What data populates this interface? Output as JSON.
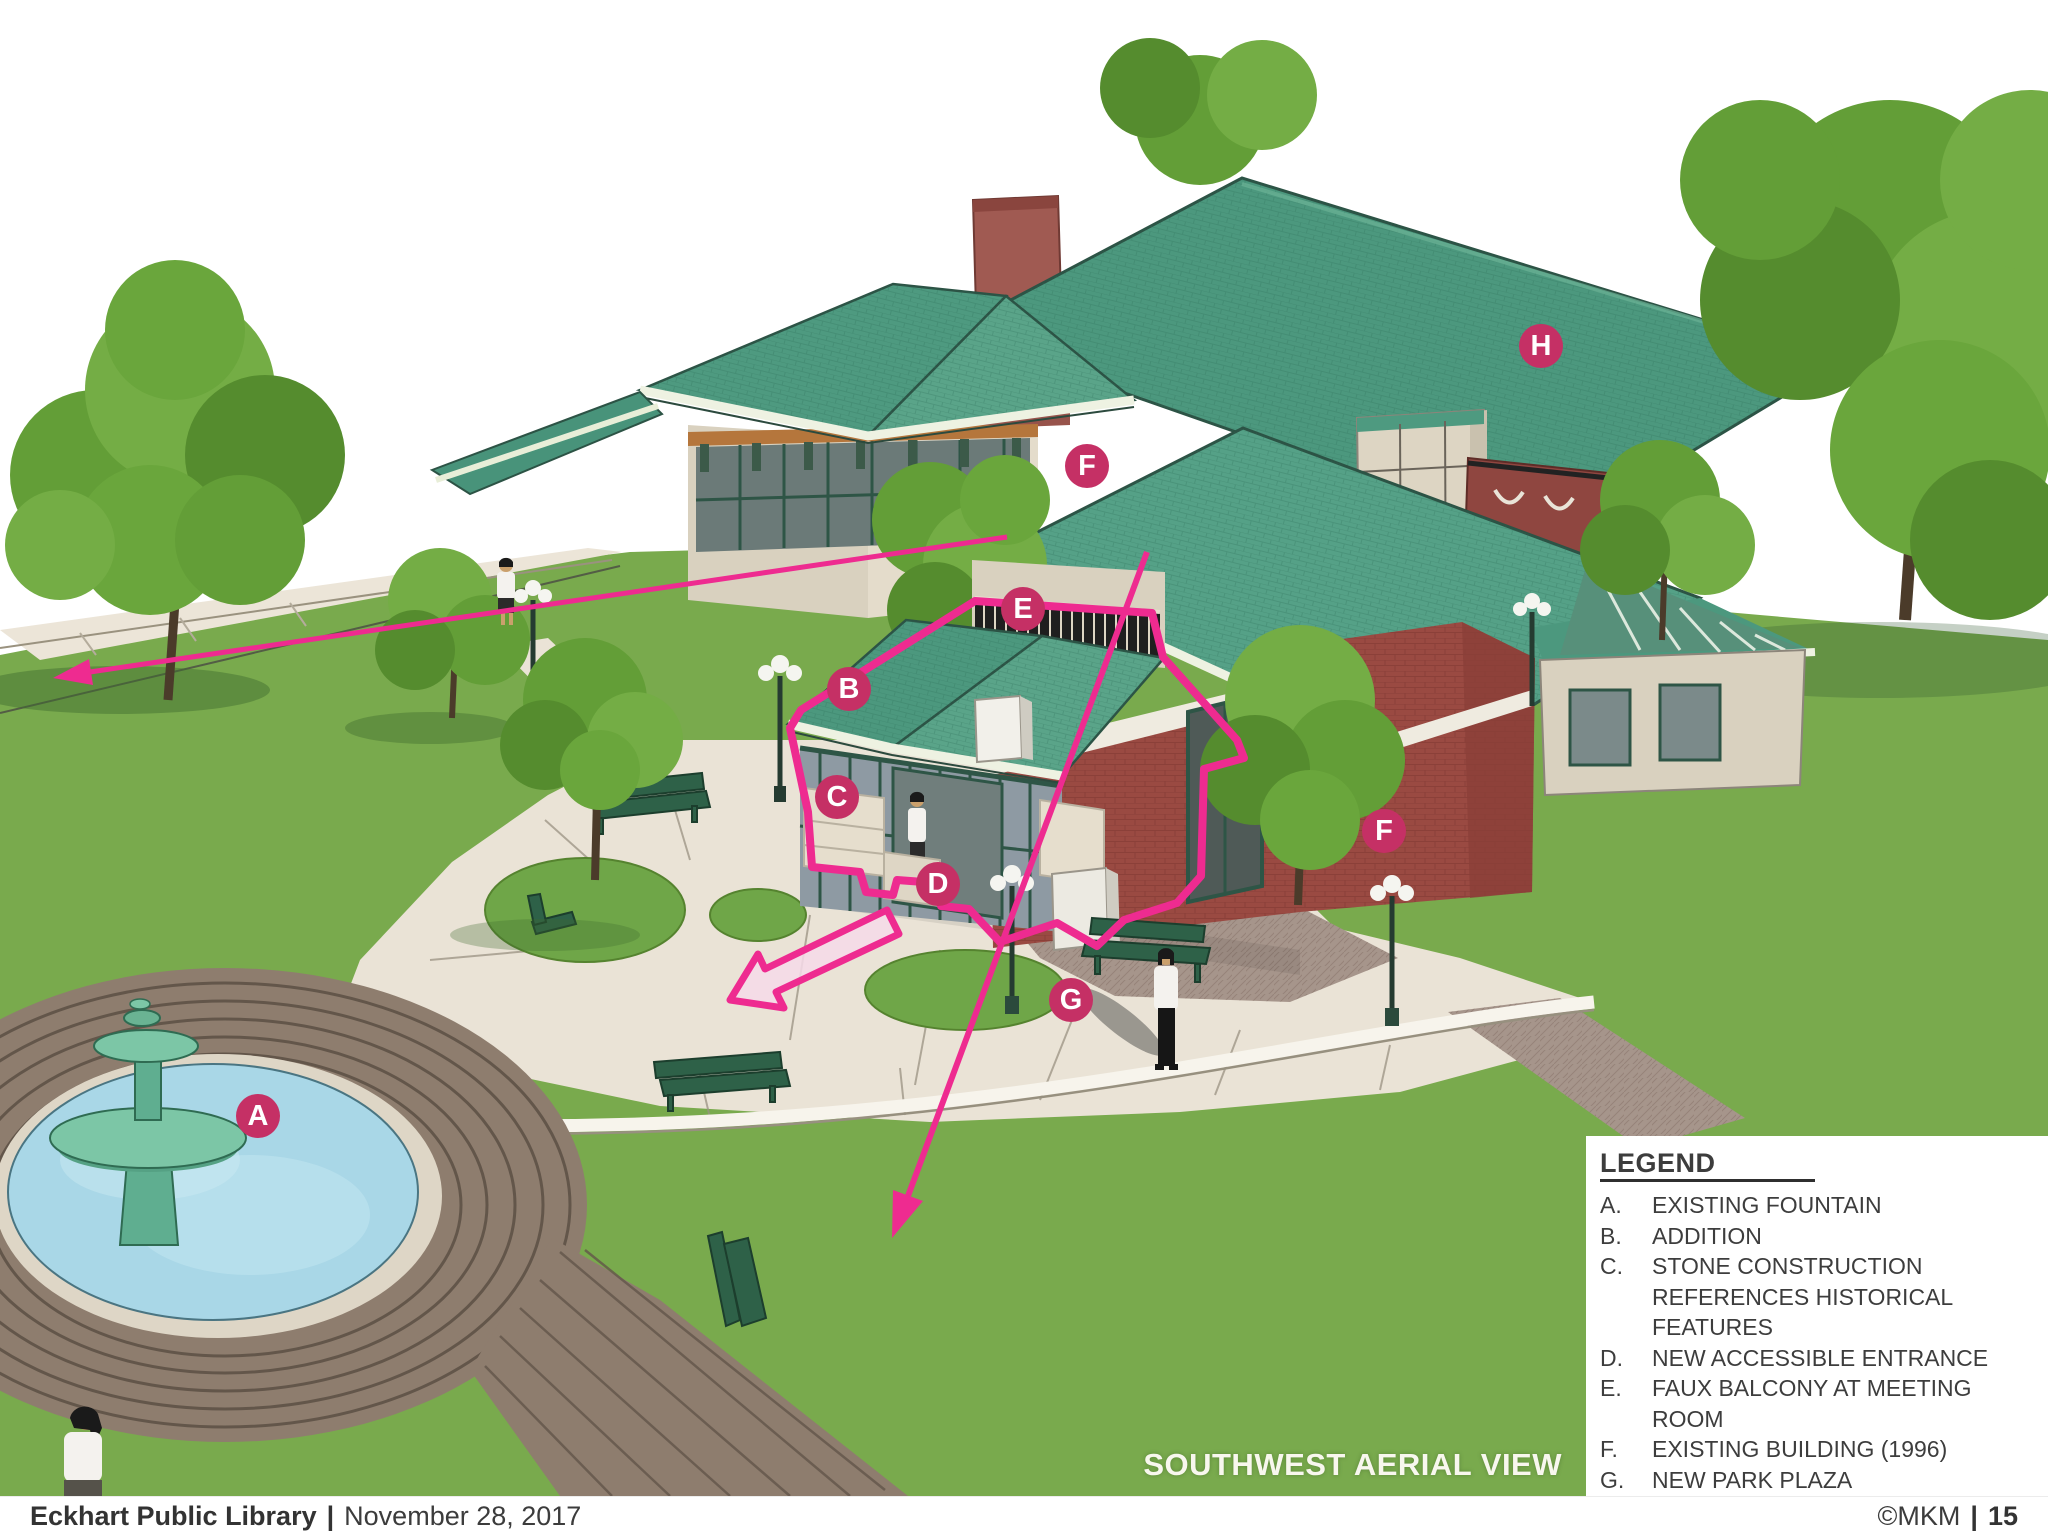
{
  "colors": {
    "annotation": "#ee2b90",
    "marker": "#c53065",
    "marker_text": "#ffffff"
  },
  "caption": "SOUTHWEST AERIAL VIEW",
  "markers": [
    {
      "label": "A",
      "name": "existing-fountain",
      "x": 258,
      "y": 1116
    },
    {
      "label": "B",
      "name": "addition",
      "x": 849,
      "y": 689
    },
    {
      "label": "C",
      "name": "stone-construction",
      "x": 837,
      "y": 797
    },
    {
      "label": "D",
      "name": "new-accessible-entrance",
      "x": 938,
      "y": 884
    },
    {
      "label": "E",
      "name": "faux-balcony-at-meeting-room",
      "x": 1023,
      "y": 609
    },
    {
      "label": "F",
      "name": "existing-building-1996-roof",
      "x": 1087,
      "y": 466
    },
    {
      "label": "F",
      "name": "existing-building-1996-wall",
      "x": 1384,
      "y": 831
    },
    {
      "label": "G",
      "name": "new-park-plaza",
      "x": 1071,
      "y": 1000
    },
    {
      "label": "H",
      "name": "existing-building-1911",
      "x": 1541,
      "y": 346
    }
  ],
  "legend": {
    "title": "LEGEND",
    "items": [
      {
        "key": "A.",
        "lines": [
          "EXISTING FOUNTAIN"
        ]
      },
      {
        "key": "B.",
        "lines": [
          "ADDITION"
        ]
      },
      {
        "key": "C.",
        "lines": [
          "STONE CONSTRUCTION",
          "REFERENCES HISTORICAL FEATURES"
        ]
      },
      {
        "key": "D.",
        "lines": [
          "NEW ACCESSIBLE ENTRANCE"
        ]
      },
      {
        "key": "E.",
        "lines": [
          "FAUX BALCONY AT MEETING ROOM"
        ]
      },
      {
        "key": "F.",
        "lines": [
          "EXISTING BUILDING (1996)"
        ]
      },
      {
        "key": "G.",
        "lines": [
          "NEW PARK PLAZA"
        ]
      },
      {
        "key": "H.",
        "lines": [
          "EXISTING BUILDING (1911)"
        ]
      }
    ]
  },
  "footer": {
    "left_bold": "Eckhart Public Library",
    "left_sep": "|",
    "left_date": "November 28, 2017",
    "right_copyright": "©MKM",
    "right_sep": "|",
    "right_page": "15"
  }
}
